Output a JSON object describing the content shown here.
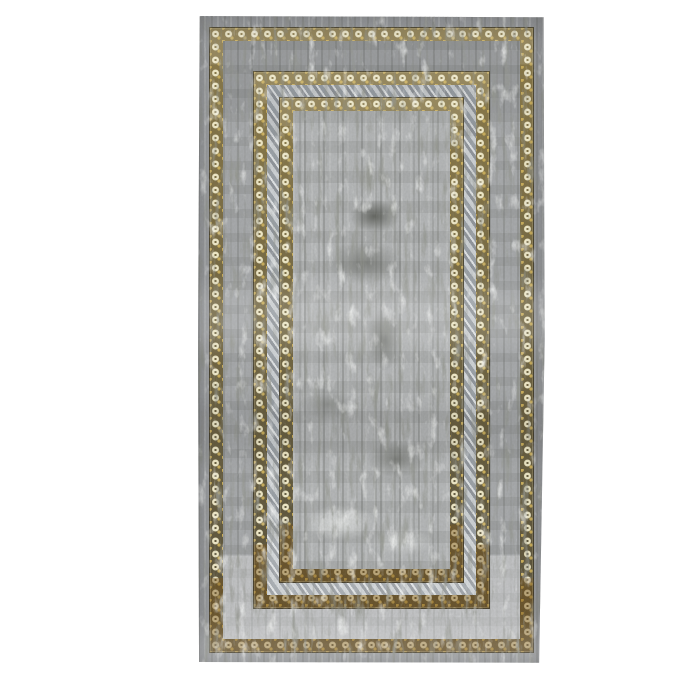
{
  "image": {
    "type": "product-photograph",
    "subject": "distressed grey and gold bordered area rug on white background",
    "visible_text": ""
  },
  "colors": {
    "canvas-bg": "#ffffff",
    "rug-margin": "#9b9da0",
    "band-plain": "#a6a8aa",
    "field-base": "#b3b5b6",
    "distress-dark": "#5e605a",
    "distress-light": "#dfe1e0",
    "gold-ground": "#57503a",
    "gold-mid": "#8a7948",
    "gold-bright": "#c9ad5a",
    "gold-cream": "#efe8c6",
    "gold-bottom-brass": "#a08030",
    "ribbon-light": "#ccd0d3",
    "ribbon-dark": "#8f949a"
  },
  "rug": {
    "border_layers": [
      "outer-margin",
      "gold-scroll-border-outer",
      "plain-grey-band",
      "gold-scroll-border-middle",
      "diagonal-ribbon-band",
      "gold-scroll-border-inner",
      "distressed-center-field"
    ]
  }
}
